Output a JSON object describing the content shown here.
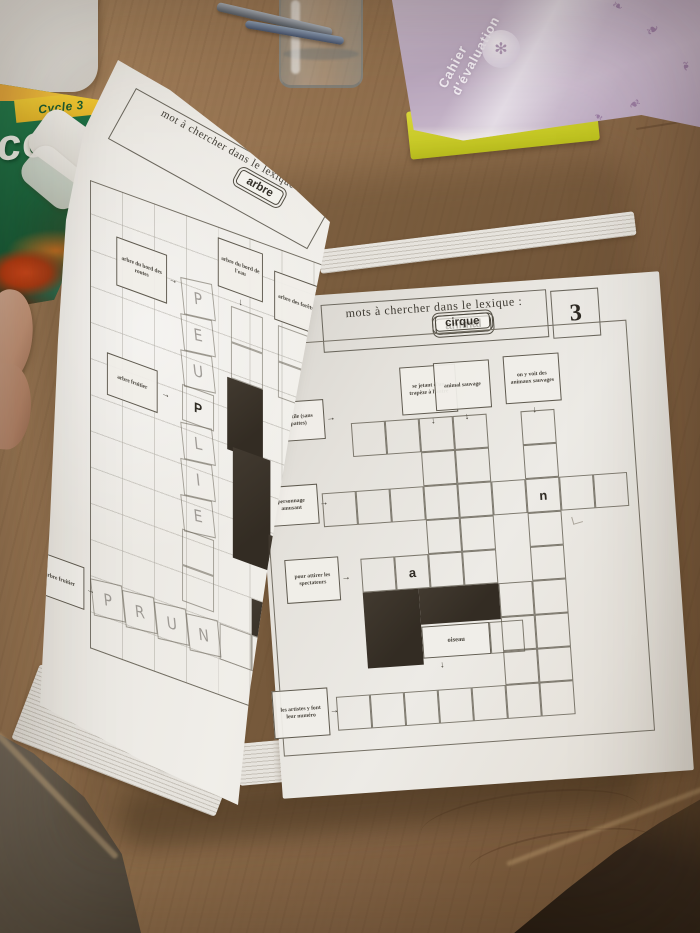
{
  "scene": {
    "arrows": {
      "down": "↓",
      "right": "→"
    },
    "colors": {
      "wood": "#8d6c4a",
      "paper": "#edebe6",
      "black_cell": "#352e25",
      "green_book": "#16603a",
      "purple_book": "#c6b5c9",
      "yellow_book": "#d5d22f"
    },
    "decor": {
      "flourish": "❧",
      "medallion_glyph": "✻"
    }
  },
  "left_page": {
    "header": "mot à chercher dans le lexique :",
    "keyword": "arbre",
    "clues": {
      "routes": "arbre du bord des routes",
      "eau": "arbre du bord de l'eau",
      "forets": "arbre des forêts",
      "fruitier_mid": "arbre fruitier",
      "fruitier_bottom": "arbre fruitier",
      "spine": "on en fait des haies"
    },
    "pencil": {
      "col1": [
        "P",
        "E",
        "U",
        "P",
        "L",
        "I",
        "E"
      ],
      "row": [
        "P",
        "R",
        "U",
        "N"
      ]
    }
  },
  "right_page": {
    "page_number": "3",
    "header": "mots à chercher dans le lexique :",
    "keywords": [
      "animal",
      "cirque"
    ],
    "clues": {
      "trapeze": "se jetant d'un trapèze à l'autre",
      "sauvage": "animal sauvage",
      "voit": "on y voit des animaux sauvages",
      "reptile": "reptile (sans pattes)",
      "personnage": "personnage amusant",
      "attirer": "pour attirer les spectateurs",
      "oiseau": "oiseau",
      "artistes": "les artistes y font leur numéro"
    },
    "letters": {
      "a": "a",
      "n": "n"
    }
  },
  "objects": {
    "green_book": {
      "band": "Cycle 3",
      "title": "ces"
    },
    "purple_book": {
      "title_line1": "Cahier",
      "title_line2": "d'évaluation"
    }
  }
}
